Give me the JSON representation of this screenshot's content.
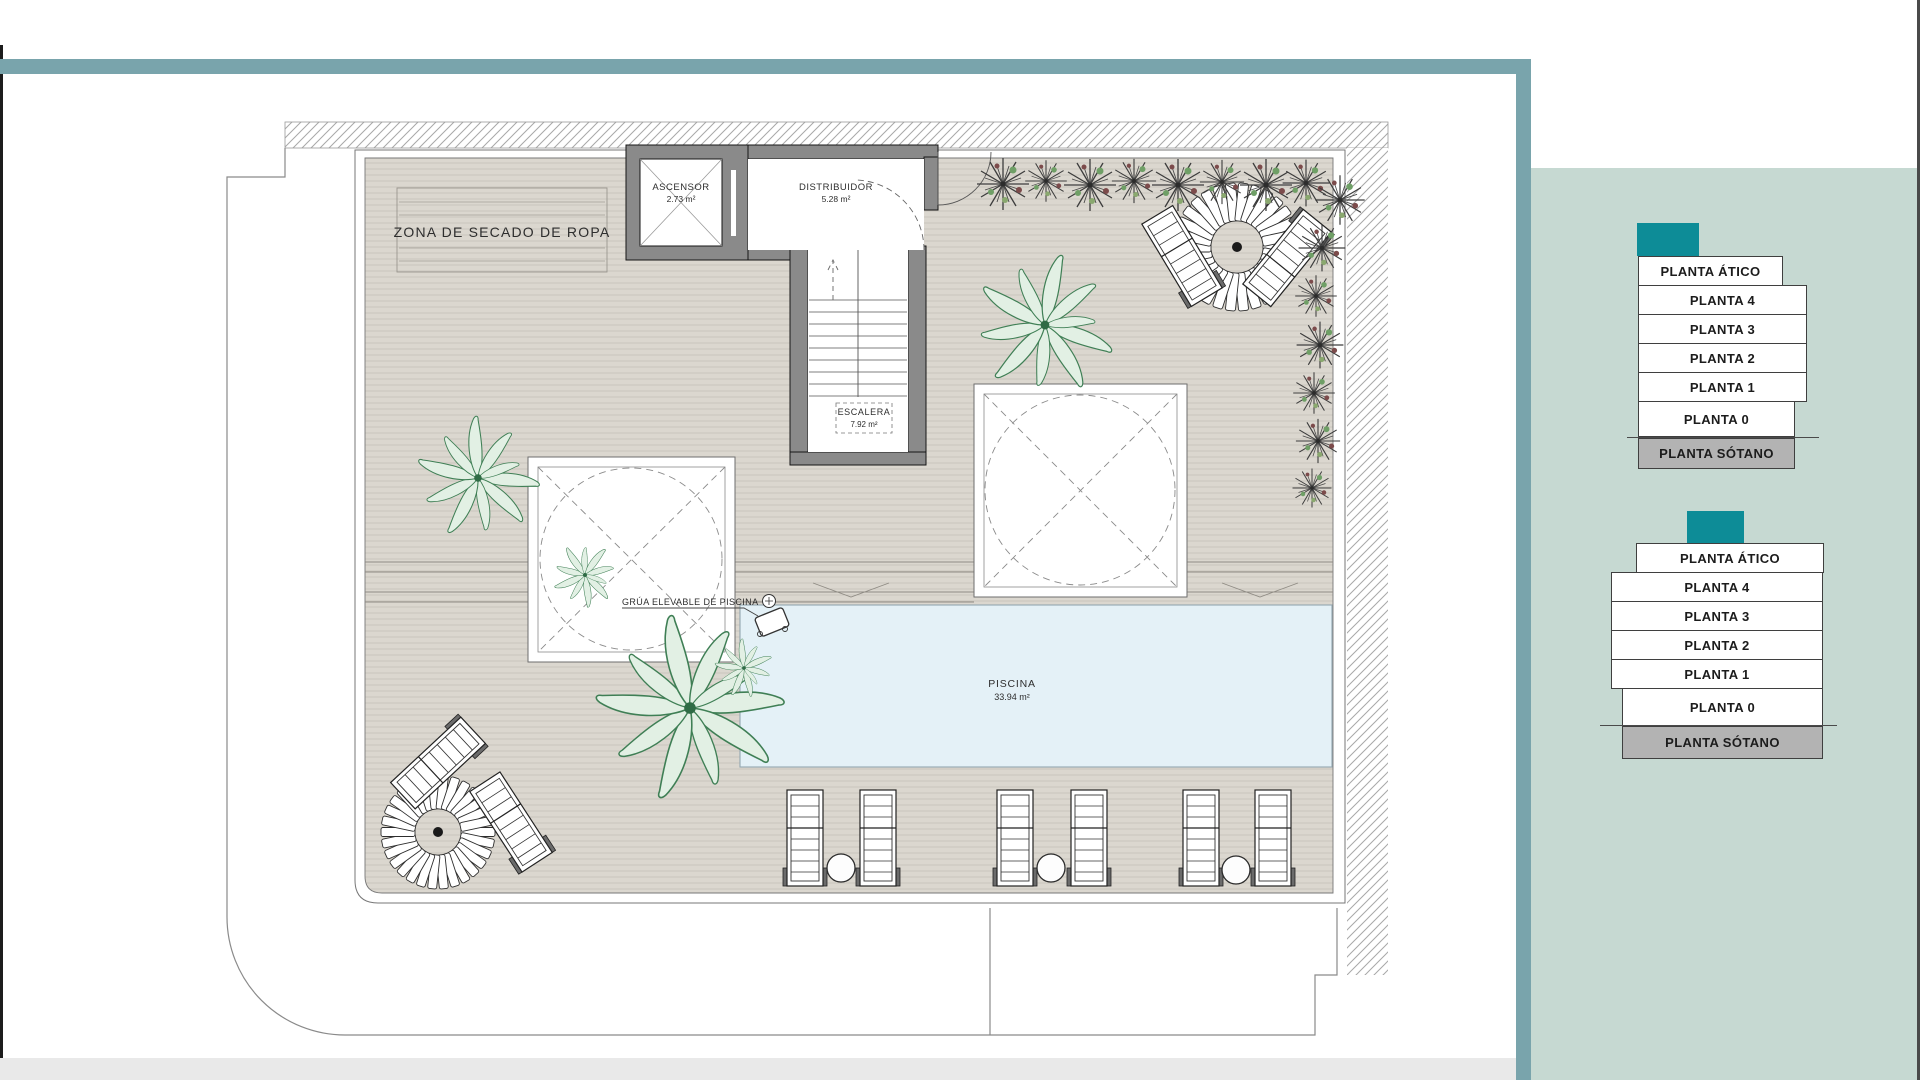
{
  "plan": {
    "drying_zone_label": "ZONA DE SECADO DE ROPA",
    "elevator": {
      "name": "ASCENSOR",
      "area": "2.73 m²"
    },
    "hall": {
      "name": "DISTRIBUIDOR",
      "area": "5.28 m²"
    },
    "stairs": {
      "name": "ESCALERA",
      "area": "7.92 m²"
    },
    "pool": {
      "name": "PISCINA",
      "area": "33.94 m²"
    },
    "crane_label": "GRÚA ELEVABLE DE PISCINA"
  },
  "selectors": [
    {
      "building": "building-a",
      "floors": [
        {
          "label": "PLANTA ÁTICO"
        },
        {
          "label": "PLANTA 4"
        },
        {
          "label": "PLANTA 3"
        },
        {
          "label": "PLANTA 2"
        },
        {
          "label": "PLANTA 1"
        },
        {
          "label": "PLANTA 0"
        },
        {
          "label": "PLANTA SÓTANO"
        }
      ]
    },
    {
      "building": "building-b",
      "floors": [
        {
          "label": "PLANTA ÁTICO"
        },
        {
          "label": "PLANTA 4"
        },
        {
          "label": "PLANTA 3"
        },
        {
          "label": "PLANTA 2"
        },
        {
          "label": "PLANTA 1"
        },
        {
          "label": "PLANTA 0"
        },
        {
          "label": "PLANTA SÓTANO"
        }
      ]
    }
  ],
  "colors": {
    "frame_teal": "#79a4ac",
    "accent_teal": "#0d8c97",
    "panel_bg": "#c6d9d2",
    "basement_gray": "#b3b3b3",
    "deck_beige": "#dbd7cf",
    "pool_blue": "#e4f1f7",
    "wall_gray": "#8a8a8a"
  }
}
